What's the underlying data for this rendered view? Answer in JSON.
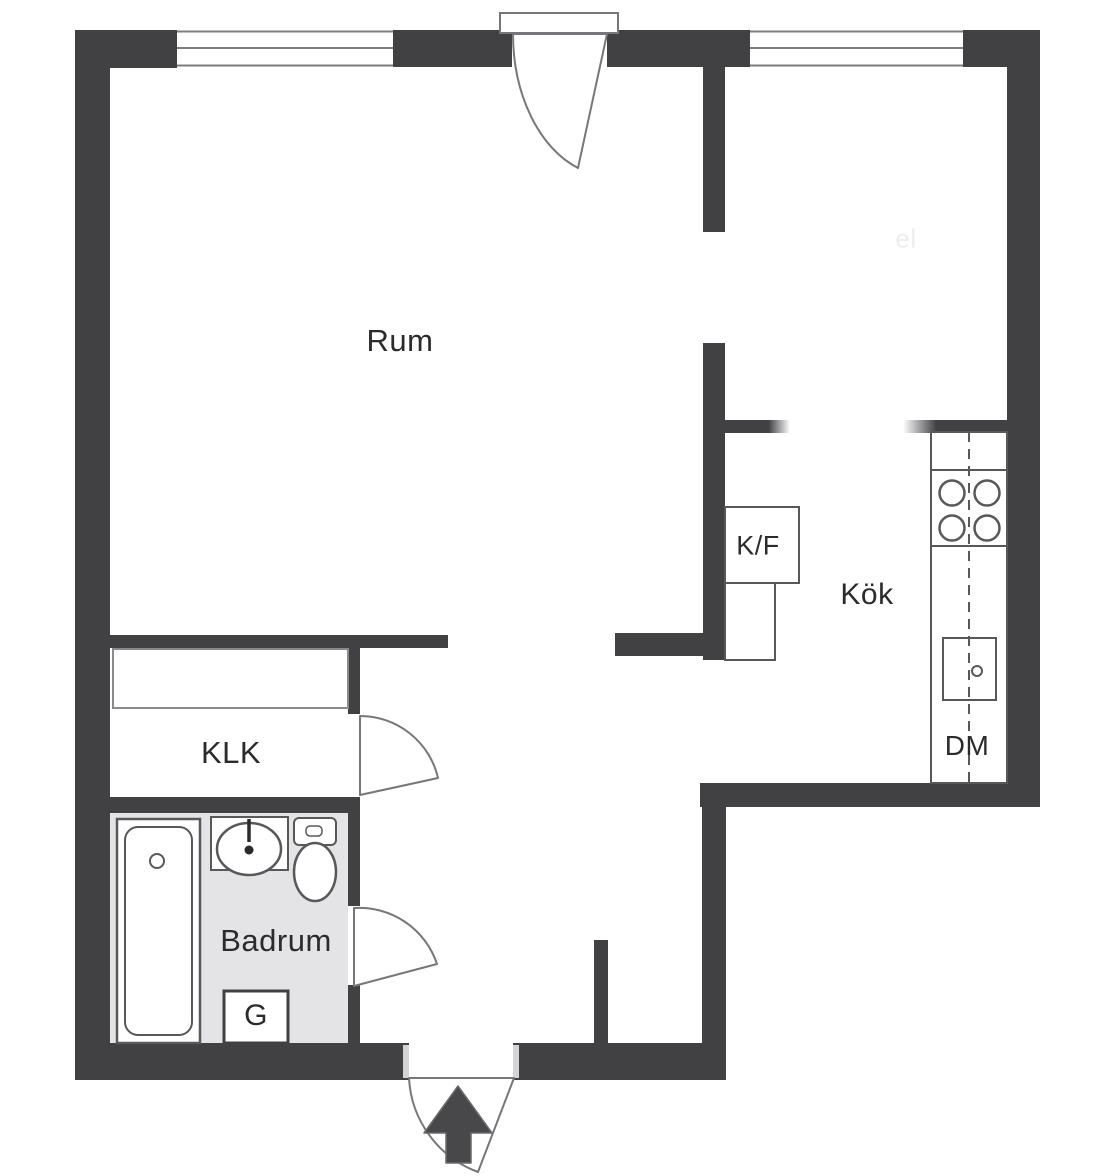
{
  "plan": {
    "title": "Swedish studio apartment floor plan",
    "labels": {
      "room": "Rum",
      "kitchen": "Kök",
      "fridge_freezer": "K/F",
      "closet": "KLK",
      "bathroom": "Badrum",
      "wardrobe": "G",
      "dishwasher": "DM",
      "watermark": "el"
    },
    "colors": {
      "wall": "#414144",
      "fixture_line": "#58585a",
      "door_line": "#77777b",
      "bathroom_floor": "#e4e4e6",
      "text": "#2b2b2b",
      "arrow": "#48484b",
      "background": "#ffffff"
    },
    "icons": {
      "entrance_arrow": "entrance-arrow-icon",
      "stove": "stove-burners-icon",
      "sink": "sink-icon",
      "toilet": "toilet-icon",
      "bathtub": "bathtub-icon"
    }
  }
}
